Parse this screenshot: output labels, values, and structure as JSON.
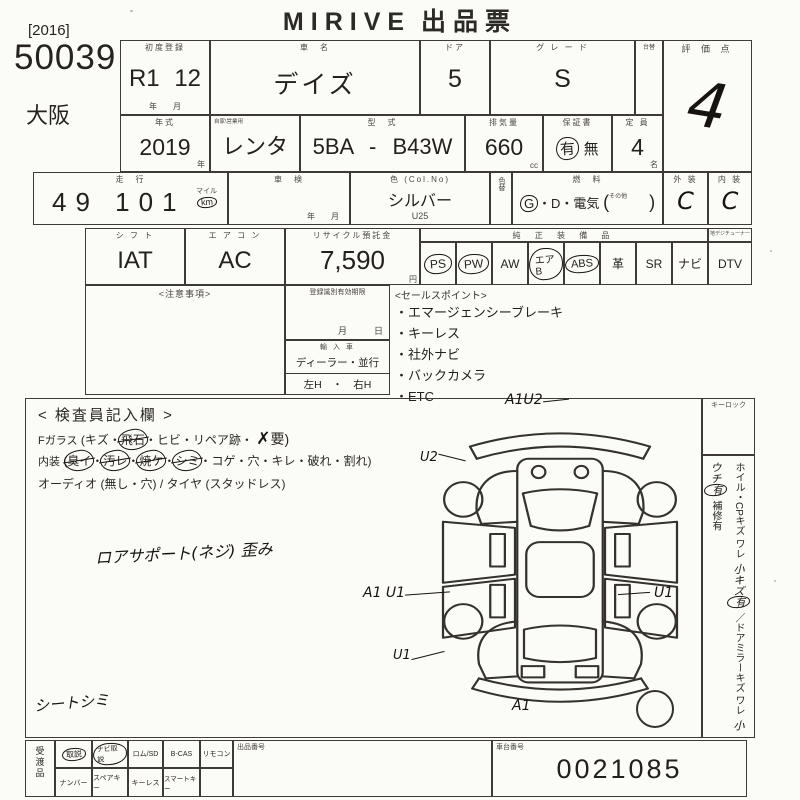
{
  "sheet": {
    "logo": "MIRIVE",
    "doc_type": "出品票"
  },
  "corner": {
    "year_bracket": "[2016]",
    "lot_number": "50039",
    "site": "大阪"
  },
  "row1": {
    "first_registration": {
      "label": "初度登録",
      "value": "R1 12",
      "units": "年　　月"
    },
    "car_name": {
      "label": "車　名",
      "value": "デイズ"
    },
    "doors": {
      "label": "ドア",
      "value": "5"
    },
    "grade": {
      "label": "グ レ ー ド",
      "value": "S"
    },
    "narrow_label": "台替",
    "score": {
      "label": "評 価 点",
      "value": "4"
    }
  },
  "row2": {
    "model_year": {
      "label": "年式",
      "value": "2019",
      "unit": "年"
    },
    "history": {
      "label": "車歴",
      "note": "自家\\営業用",
      "value": "レンタ"
    },
    "model_code": {
      "label": "型　式",
      "value": "5BA - B43W"
    },
    "displacement": {
      "label": "排気量",
      "value": "660",
      "unit": "cc"
    },
    "warranty": {
      "label": "保証書",
      "circled": "有",
      "plain": "無"
    },
    "capacity": {
      "label": "定 員",
      "value": "4",
      "unit": "名"
    }
  },
  "row3": {
    "mileage": {
      "label": "走　行",
      "value": "49 101",
      "unit_top": "マイル",
      "unit_circled": "km"
    },
    "shaken": {
      "label": "車　検",
      "units": "年　　月"
    },
    "color": {
      "label": "色 (Col.No)",
      "value": "シルバー",
      "code": "U25"
    },
    "color_change_label": "色替",
    "fuel": {
      "label": "燃　料",
      "circled": "G",
      "rest": "・D・電気",
      "paren_open": "(",
      "other_label": "その他",
      "paren_close": ")"
    },
    "exterior": {
      "label": "外 装",
      "value": "C"
    },
    "interior": {
      "label": "内 装",
      "value": "C"
    }
  },
  "row4": {
    "shift": {
      "label": "シ フ ト",
      "value": "IAT"
    },
    "aircon": {
      "label": "エ ア コ ン",
      "value": "AC"
    },
    "recycle_fee": {
      "label": "リサイクル預託金",
      "value": "7,590",
      "unit": "円"
    },
    "oem_label": "純 正 装 備 品",
    "dtv_header": "地デジチューナー",
    "equipment": [
      {
        "name": "PS",
        "circled": true
      },
      {
        "name": "PW",
        "circled": true
      },
      {
        "name": "AW",
        "circled": false
      },
      {
        "name": "エアB",
        "circled": true
      },
      {
        "name": "ABS",
        "circled": true
      },
      {
        "name": "革",
        "circled": false
      },
      {
        "name": "SR",
        "circled": false
      },
      {
        "name": "ナビ",
        "circled": false
      },
      {
        "name": "DTV",
        "circled": false
      }
    ]
  },
  "mid": {
    "notes_label": "<注意事項>",
    "registration_box": {
      "label": "登録識別有効期限",
      "units": "月　　　日"
    },
    "import_box": {
      "label": "輸 入 車",
      "line1": "ディーラー・並行",
      "line2": "左H　・　右H"
    },
    "sales_points": {
      "label": "<セールスポイント>",
      "bullet": "・",
      "items": [
        "エマージェンシーブレーキ",
        "キーレス",
        "社外ナビ",
        "バックカメラ",
        "ETC"
      ]
    }
  },
  "inspector": {
    "title": "< 検査員記入欄 >",
    "f_glass": {
      "head": "Fガラス",
      "pre": "(キズ・",
      "struck": "飛石",
      "mid": "・ヒビ・リペア跡・",
      "hand_mark": "✗",
      "tail": "要)"
    },
    "interior_line": {
      "head": "内装",
      "paren_open": "(",
      "sep": "・",
      "struck_items": [
        "臭イ",
        "汚レ",
        "焼ケ",
        "シミ"
      ],
      "rest": "コゲ・穴・キレ・破れ・割れ)"
    },
    "audio_line": "オーディオ (無し・穴) / タイヤ (スタッドレス)",
    "hand_note_1": "ロアサポート(ネジ)  歪み",
    "hand_note_2": "シートシミ",
    "marks": {
      "top": "A1U2",
      "upper_left": "U2",
      "left": "A1 U1",
      "right": "U1",
      "lower_left": "U1",
      "bottom": "A1"
    },
    "keylock_label": "キーロック",
    "right_strip": {
      "printed_1": "ホイル・CPキズ ワレ",
      "hand_1": "小キズ",
      "hand_1_mark": "有",
      "printed_2": "／ドアミラーキズ ワレ",
      "hand_2": "小ウチ",
      "hand_2_mark": "有",
      "printed_3": "補修有"
    }
  },
  "bottom": {
    "handover_label": "受渡品",
    "row1": [
      {
        "name": "取説",
        "circled": true
      },
      {
        "name": "ナビ取説",
        "circled": true
      },
      {
        "name": "ロム/SD",
        "circled": false
      },
      {
        "name": "B-CAS",
        "circled": false
      },
      {
        "name": "リモコン",
        "circled": false
      }
    ],
    "row2": [
      "ナンバー",
      "スペアキー",
      "キーレス",
      "スマートキー"
    ],
    "listing_no_label": "出品番号",
    "chassis": {
      "label": "車台番号",
      "value": "0021085"
    }
  }
}
